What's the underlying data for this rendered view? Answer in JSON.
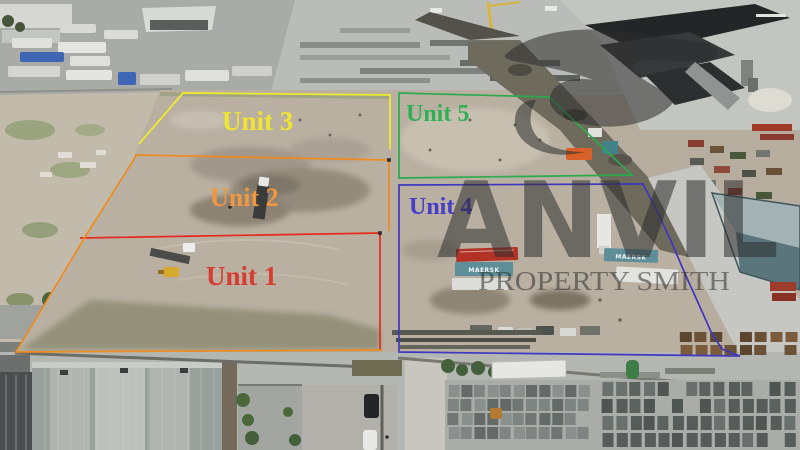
{
  "units": [
    {
      "name": "Unit 1",
      "line_color": "#e6291c",
      "label_color": "#d63c30",
      "label": {
        "x": 206,
        "y": 285,
        "size": 27
      },
      "lines": [
        {
          "points": "80,238 380,233 380,351",
          "closed": false
        }
      ],
      "corner_dots": [
        [
          380,
          233
        ]
      ]
    },
    {
      "name": "Unit 2",
      "line_color": "#ef8b1e",
      "label_color": "#f0973f",
      "label": {
        "x": 210,
        "y": 206,
        "size": 26
      },
      "lines": [
        {
          "points": "135,155 389,160 389,231",
          "closed": false
        },
        {
          "points": "136,156 85,237 16,352 382,350",
          "closed": false
        }
      ],
      "corner_dots": [
        [
          389,
          160
        ]
      ]
    },
    {
      "name": "Unit 3",
      "line_color": "#f2ed28",
      "label_color": "#efe42f",
      "label": {
        "x": 222,
        "y": 130,
        "size": 27
      },
      "lines": [
        {
          "points": "139,144 183,93 390,95 390,149",
          "closed": false
        }
      ],
      "corner_dots": []
    },
    {
      "name": "Unit 4",
      "line_color": "#3f37c0",
      "label_color": "#453cc8",
      "label": {
        "x": 409,
        "y": 214,
        "size": 24
      },
      "lines": [
        {
          "points": "399,185 643,184 658,213 671,241 686,276 700,307 712,334 722,349 740,356 399,352",
          "closed": true
        }
      ],
      "corner_dots": []
    },
    {
      "name": "Unit 5",
      "line_color": "#2cab4e",
      "label_color": "#2fb054",
      "label": {
        "x": 406,
        "y": 121,
        "size": 24
      },
      "lines": [
        {
          "points": "399,93 549,97 632,175 399,178",
          "closed": true
        }
      ],
      "corner_dots": []
    }
  ],
  "watermark": {
    "brand": "ANVIL",
    "tagline": "PROPERTY SMITH",
    "color": "#2e2e2e",
    "opacity": 0.55
  },
  "containers": [
    {
      "label": "MAERSK"
    },
    {
      "label": "MAERSK"
    }
  ]
}
